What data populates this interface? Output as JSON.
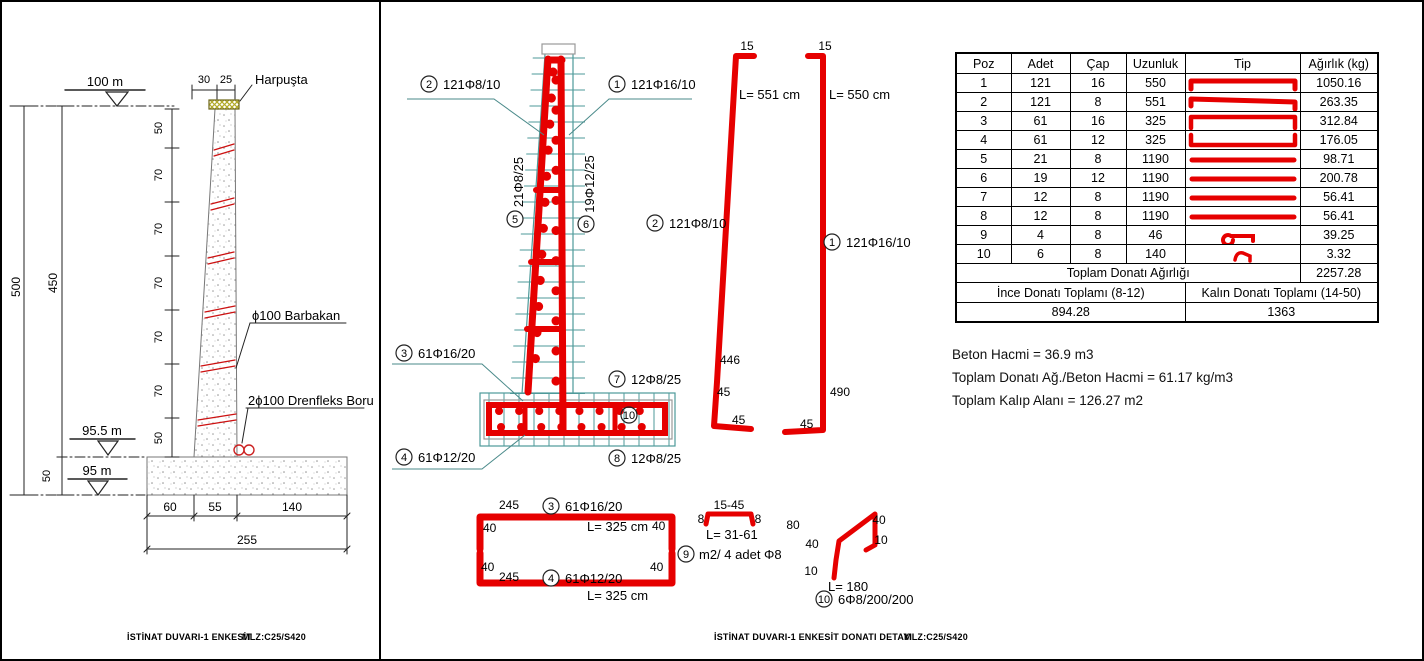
{
  "colors": {
    "rebar_red": "#e60000",
    "grid_teal": "#4e9a9a",
    "hatch_olive": "#b3ab28",
    "line_black": "#222222"
  },
  "left": {
    "title": "İSTİNAT DUVARI-1  ENKESİT",
    "material": "MLZ:C25/S420",
    "elev_top": "100 m",
    "elev_mid": "95.5 m",
    "elev_bot": "95 m",
    "harpusta": "Harpuşta",
    "barbakan": "ϕ100 Barbakan",
    "drenfleks": "2ϕ100 Drenfleks Boru",
    "dim_top_a": "30",
    "dim_top_b": "25",
    "dim_total_h": "500",
    "dim_stem_h": "450",
    "dim_found_h": "50",
    "ladder": [
      "50",
      "70",
      "70",
      "70",
      "70",
      "70",
      "50"
    ],
    "dim_base_a": "60",
    "dim_base_b": "55",
    "dim_base_c": "140",
    "dim_base_total": "255"
  },
  "middle": {
    "title": "İSTİNAT DUVARI-1 ENKESİT DONATI DETAYI",
    "material": "MLZ:C25/S420",
    "c1": {
      "n": "1",
      "t": "121Φ16/10"
    },
    "c2": {
      "n": "2",
      "t": "121Φ8/10"
    },
    "c3": {
      "n": "3",
      "t": "61Φ16/20"
    },
    "c4": {
      "n": "4",
      "t": "61Φ12/20"
    },
    "c5": {
      "n": "5",
      "t": "21Φ8/25"
    },
    "c6": {
      "n": "6",
      "t": "19Φ12/25"
    },
    "c7": {
      "n": "7",
      "t": "12Φ8/25"
    },
    "c8": {
      "n": "8",
      "t": "12Φ8/25"
    },
    "c9": {
      "n": "9",
      "t": "m2/ 4 adet Φ8"
    },
    "c10": {
      "n": "10",
      "t": "6Φ8/200/200"
    },
    "bar2": {
      "hook": "15",
      "len": "L= 551 cm",
      "h1": "446",
      "h2": "45",
      "leg": "45"
    },
    "bar1": {
      "hook": "15",
      "len": "L= 550 cm",
      "h": "490",
      "leg": "45"
    },
    "rect_top": {
      "w": "245",
      "leg_l": "40",
      "leg_r": "40",
      "len": "L= 325 cm"
    },
    "rect_bot": {
      "w": "245",
      "leg_l": "40",
      "leg_r": "40",
      "len": "L= 325 cm"
    },
    "s9": {
      "top": "15-45",
      "l": "8",
      "r": "8",
      "len": "L= 31-61"
    },
    "s10": {
      "diag": "80",
      "l40": "40",
      "l10": "10",
      "r40": "40",
      "r10": "10",
      "len": "L= 180"
    }
  },
  "table": {
    "headers": [
      "Poz",
      "Adet",
      "Çap",
      "Uzunluk",
      "Tip",
      "Ağırlık (kg)"
    ],
    "rows": [
      {
        "poz": "1",
        "adet": "121",
        "cap": "16",
        "uzunluk": "550",
        "tip": "bar-hooks-down",
        "agirlik": "1050.16"
      },
      {
        "poz": "2",
        "adet": "121",
        "cap": "8",
        "uzunluk": "551",
        "tip": "bar-slant-hooks",
        "agirlik": "263.35"
      },
      {
        "poz": "3",
        "adet": "61",
        "cap": "16",
        "uzunluk": "325",
        "tip": "u-open-bottom",
        "agirlik": "312.84"
      },
      {
        "poz": "4",
        "adet": "61",
        "cap": "12",
        "uzunluk": "325",
        "tip": "u-open-top",
        "agirlik": "176.05"
      },
      {
        "poz": "5",
        "adet": "21",
        "cap": "8",
        "uzunluk": "1190",
        "tip": "straight",
        "agirlik": "98.71"
      },
      {
        "poz": "6",
        "adet": "19",
        "cap": "12",
        "uzunluk": "1190",
        "tip": "straight",
        "agirlik": "200.78"
      },
      {
        "poz": "7",
        "adet": "12",
        "cap": "8",
        "uzunluk": "1190",
        "tip": "straight",
        "agirlik": "56.41"
      },
      {
        "poz": "8",
        "adet": "12",
        "cap": "8",
        "uzunluk": "1190",
        "tip": "straight",
        "agirlik": "56.41"
      },
      {
        "poz": "9",
        "adet": "4",
        "cap": "8",
        "uzunluk": "46",
        "tip": "hook",
        "agirlik": "39.25"
      },
      {
        "poz": "10",
        "adet": "6",
        "cap": "8",
        "uzunluk": "140",
        "tip": "zigzag",
        "agirlik": "3.32"
      }
    ],
    "total_label": "Toplam Donatı Ağırlığı",
    "total_value": "2257.28",
    "ince_label": "İnce Donatı Toplamı (8-12)",
    "kalin_label": "Kalın Donatı Toplamı (14-50)",
    "ince_value": "894.28",
    "kalin_value": "1363"
  },
  "notes": {
    "a": "Beton Hacmi = 36.9 m3",
    "b": "Toplam Donatı Ağ./Beton Hacmi = 61.17 kg/m3",
    "c": "Toplam Kalıp Alanı = 126.27 m2"
  }
}
